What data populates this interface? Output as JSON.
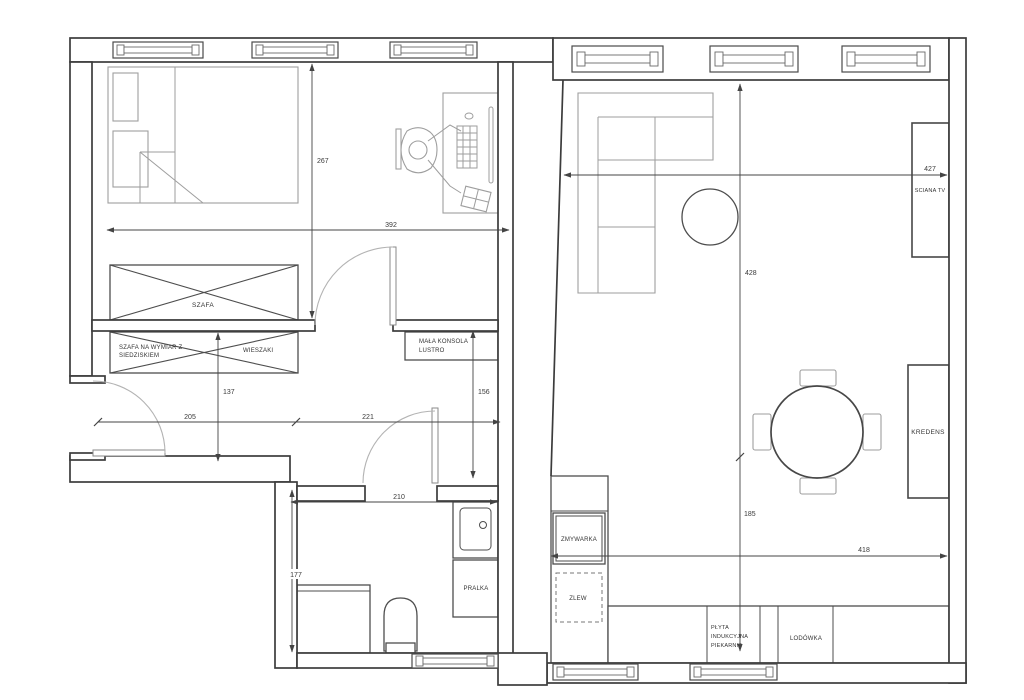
{
  "drawing": {
    "kind": "apartment-floor-plan"
  },
  "labels": {
    "szafa": "SZAFA",
    "szafa_na_wymiar_line1": "SZAFA NA WYMIAR Z",
    "szafa_na_wymiar_line2": "SIEDZISKIEM",
    "wieszaki": "WIESZAKI",
    "konsola_line1": "MAŁA KONSOLA",
    "konsola_line2": "LUSTRO",
    "zmywarka": "ZMYWARKA",
    "zlew": "ZLEW",
    "pralka": "PRALKA",
    "plyta_line1": "PŁYTA",
    "plyta_line2": "INDUKCYJNA",
    "plyta_line3": "PIEKARNIK",
    "lodowka": "LODÓWKA",
    "kredens": "KREDENS",
    "sciana_tv": "SCIANA TV"
  },
  "dims": {
    "bedroom_depth": "267",
    "bedroom_width": "392",
    "wardrobe_run": "137",
    "hall_seg_left": "205",
    "hall_seg_right": "221",
    "console_run": "156",
    "bathroom_width": "210",
    "bathroom_depth": "177",
    "living_width": "427",
    "living_depth": "428",
    "kitchen_depth": "185",
    "kitchen_width": "418"
  },
  "colors": {
    "wall": "#3c3c3c",
    "furniture": "#9e9e9e",
    "fixture": "#4d4d4d",
    "dimension_text": "#3a3a3a",
    "door_arc": "#b3b3b3",
    "background": "#ffffff"
  }
}
